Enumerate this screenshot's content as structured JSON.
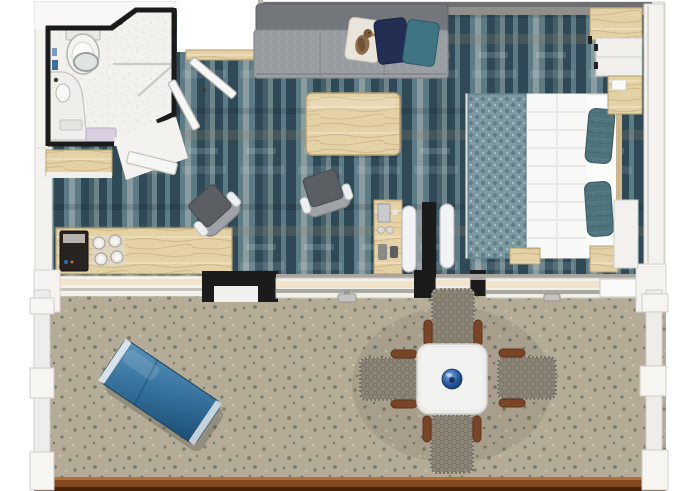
{
  "scene": {
    "kind": "floor-plan",
    "title": "Hotel suite 3D top-down floor plan with terrace",
    "width_px": 680,
    "height_px": 491
  },
  "rooms": [
    {
      "id": "bathroom",
      "label": "Bathroom"
    },
    {
      "id": "entry",
      "label": "Entry hall"
    },
    {
      "id": "living-area",
      "label": "Living area"
    },
    {
      "id": "bedroom",
      "label": "Bedroom"
    },
    {
      "id": "terrace",
      "label": "Terrace / balcony"
    }
  ],
  "furniture": [
    {
      "id": "toilet",
      "room": "bathroom"
    },
    {
      "id": "vanity-sink",
      "room": "bathroom"
    },
    {
      "id": "round-mirror",
      "room": "bathroom"
    },
    {
      "id": "shower",
      "room": "bathroom"
    },
    {
      "id": "towels",
      "room": "bathroom"
    },
    {
      "id": "closet-shelf",
      "room": "entry"
    },
    {
      "id": "work-desk",
      "room": "living-area"
    },
    {
      "id": "coffee-machine",
      "room": "living-area"
    },
    {
      "id": "glass-set",
      "room": "living-area"
    },
    {
      "id": "sofa",
      "room": "living-area"
    },
    {
      "id": "cushion-bird",
      "room": "living-area"
    },
    {
      "id": "cushion-navy",
      "room": "living-area"
    },
    {
      "id": "cushion-teal",
      "room": "living-area"
    },
    {
      "id": "coffee-table",
      "room": "living-area"
    },
    {
      "id": "armchair",
      "room": "living-area",
      "count": 2
    },
    {
      "id": "minibar-console",
      "room": "living-area"
    },
    {
      "id": "sliding-partition",
      "room": "living-area"
    },
    {
      "id": "wardrobe",
      "room": "bedroom"
    },
    {
      "id": "double-bed",
      "room": "bedroom"
    },
    {
      "id": "bed-runner",
      "room": "bedroom"
    },
    {
      "id": "bed-pillow",
      "room": "bedroom",
      "count": 2
    },
    {
      "id": "nightstand",
      "room": "bedroom",
      "count": 2
    },
    {
      "id": "bedside-cabinet",
      "room": "bedroom"
    },
    {
      "id": "luggage-bench",
      "room": "bedroom"
    },
    {
      "id": "sun-lounger",
      "room": "terrace"
    },
    {
      "id": "dining-table",
      "room": "terrace"
    },
    {
      "id": "dining-chair",
      "room": "terrace",
      "count": 4
    },
    {
      "id": "decor-bowl",
      "room": "terrace"
    },
    {
      "id": "patio-sliding-door",
      "count": 2
    },
    {
      "id": "entry-door-leaf",
      "count": 2
    },
    {
      "id": "bathroom-door-leaf",
      "count": 1
    }
  ],
  "colors": {
    "page_bg": "#ffffff",
    "wall_black": "#1b1b1b",
    "wall_white": "#f3f2ef",
    "wall_gray": "#6f7072",
    "wall_trim": "#d5d3ce",
    "carpet_base": "#45606b",
    "carpet_dark": "#2f4a56",
    "carpet_mid": "#5d7b85",
    "carpet_light": "#95a8ab",
    "carpet_brown": "#8a7f6d",
    "bath_floor": "#f2f1ed",
    "wood_light": "#e4d1a4",
    "wood_grain": "#c9b184",
    "wood_edge": "#b49e72",
    "terrace_base": "#b4ac97",
    "terrace_dot_dark": "#857d68",
    "terrace_dot_light": "#cdc5ae",
    "rail_light": "#b06f38",
    "rail_brown": "#84481f",
    "rail_dark": "#47230c",
    "sofa_back": "#73767b",
    "sofa_seat": "#9b9ea3",
    "cushion_cream": "#e9e5da",
    "cushion_navy": "#232f52",
    "cushion_teal": "#3f7582",
    "chair_seat": "#5b5e63",
    "chair_back": "#9fa2a6",
    "bed_white": "#f6f6f4",
    "runner_base": "#7d9aa2",
    "runner_dark": "#5d7e88",
    "pillow_teal": "#4e737b",
    "lounger_light": "#5a93ba",
    "lounger_mid": "#35719c",
    "lounger_dark": "#1c4c72",
    "wicker_base": "#8d8577",
    "wicker_dark": "#7b7365",
    "armrest_brown": "#7a4526",
    "table_white": "#ececea",
    "bowl_blue": "#2456a0",
    "door_white": "#f6f6f4",
    "glass_sill": "#f2e3cb",
    "track_gray": "#aaa79f"
  }
}
